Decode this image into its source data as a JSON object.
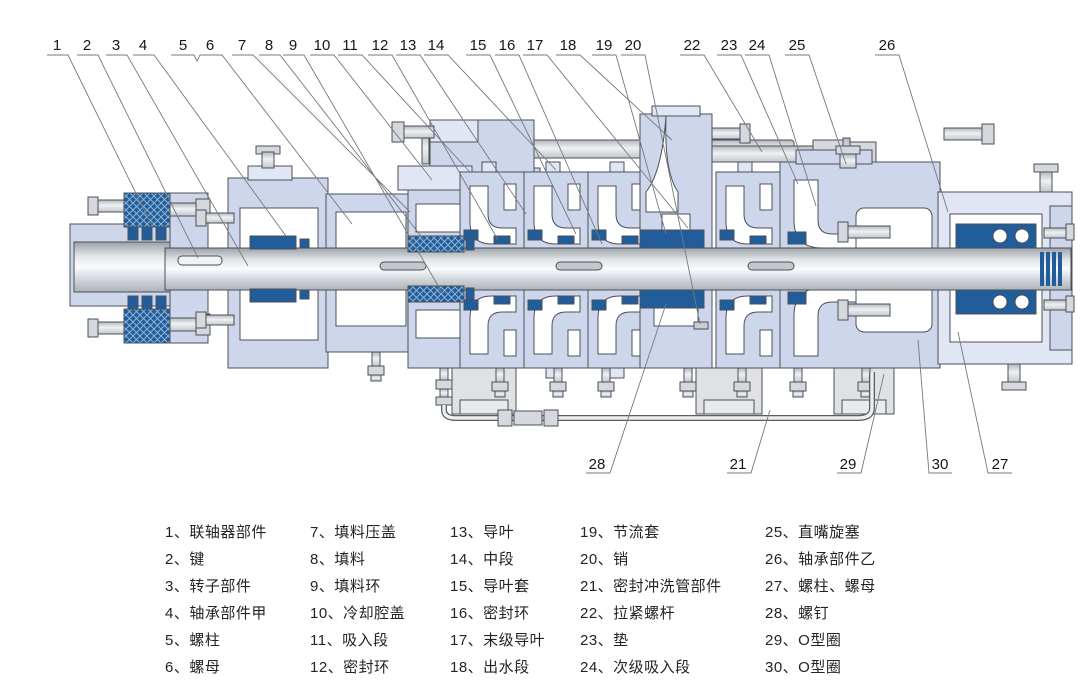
{
  "diagram_title": "multistage-pump-cross-section",
  "colors": {
    "casing": "#cdd6ea",
    "casing_light": "#e0e6f4",
    "dark_blue": "#205d9a",
    "hatch_line": "#8fb4d6",
    "outline": "#4b5058",
    "white": "#ffffff",
    "foot_gray": "#e0e1e3",
    "metal_gray": "#d5d9dd",
    "leader_gray": "#75797f"
  },
  "callouts": {
    "top": [
      {
        "n": "1",
        "x": 57,
        "y": 50,
        "leader": [
          [
            47,
            55
          ],
          [
            68,
            55
          ],
          [
            152,
            226
          ]
        ]
      },
      {
        "n": "2",
        "x": 87,
        "y": 50,
        "leader": [
          [
            77,
            55
          ],
          [
            98,
            55
          ],
          [
            198,
            258
          ]
        ]
      },
      {
        "n": "3",
        "x": 116,
        "y": 50,
        "leader": [
          [
            106,
            55
          ],
          [
            127,
            55
          ],
          [
            248,
            266
          ]
        ]
      },
      {
        "n": "4",
        "x": 143,
        "y": 50,
        "leader": [
          [
            133,
            55
          ],
          [
            154,
            55
          ],
          [
            286,
            236
          ]
        ]
      },
      {
        "n": "5",
        "x": 183,
        "y": 50,
        "leader": [
          [
            171,
            55
          ],
          [
            194,
            55
          ],
          [
            197,
            61
          ],
          [
            200,
            55
          ]
        ]
      },
      {
        "n": "6",
        "x": 210,
        "y": 50,
        "leader": [
          [
            200,
            55
          ],
          [
            222,
            55
          ],
          [
            352,
            224
          ]
        ]
      },
      {
        "n": "7",
        "x": 242,
        "y": 50,
        "leader": [
          [
            232,
            55
          ],
          [
            253,
            55
          ],
          [
            410,
            212
          ]
        ]
      },
      {
        "n": "8",
        "x": 269,
        "y": 50,
        "leader": [
          [
            259,
            55
          ],
          [
            280,
            55
          ],
          [
            424,
            240
          ]
        ]
      },
      {
        "n": "9",
        "x": 293,
        "y": 50,
        "leader": [
          [
            283,
            55
          ],
          [
            304,
            55
          ],
          [
            444,
            296
          ]
        ]
      },
      {
        "n": "10",
        "x": 322,
        "y": 50,
        "leader": [
          [
            310,
            55
          ],
          [
            334,
            55
          ],
          [
            432,
            180
          ]
        ]
      },
      {
        "n": "11",
        "x": 350,
        "y": 50,
        "leader": [
          [
            338,
            55
          ],
          [
            362,
            55
          ],
          [
            470,
            172
          ]
        ]
      },
      {
        "n": "12",
        "x": 380,
        "y": 50,
        "leader": [
          [
            368,
            55
          ],
          [
            392,
            55
          ],
          [
            498,
            240
          ]
        ]
      },
      {
        "n": "13",
        "x": 408,
        "y": 50,
        "leader": [
          [
            396,
            55
          ],
          [
            420,
            55
          ],
          [
            526,
            214
          ]
        ]
      },
      {
        "n": "14",
        "x": 436,
        "y": 50,
        "leader": [
          [
            424,
            55
          ],
          [
            448,
            55
          ],
          [
            556,
            170
          ]
        ]
      },
      {
        "n": "15",
        "x": 478,
        "y": 50,
        "leader": [
          [
            466,
            55
          ],
          [
            490,
            55
          ],
          [
            576,
            234
          ]
        ]
      },
      {
        "n": "16",
        "x": 507,
        "y": 50,
        "leader": [
          [
            495,
            55
          ],
          [
            519,
            55
          ],
          [
            602,
            244
          ]
        ]
      },
      {
        "n": "17",
        "x": 535,
        "y": 50,
        "leader": [
          [
            523,
            55
          ],
          [
            547,
            55
          ],
          [
            688,
            228
          ]
        ]
      },
      {
        "n": "18",
        "x": 568,
        "y": 50,
        "leader": [
          [
            556,
            55
          ],
          [
            580,
            55
          ],
          [
            672,
            140
          ]
        ]
      },
      {
        "n": "19",
        "x": 604,
        "y": 50,
        "leader": [
          [
            592,
            55
          ],
          [
            616,
            55
          ],
          [
            666,
            234
          ]
        ]
      },
      {
        "n": "20",
        "x": 633,
        "y": 50,
        "leader": [
          [
            621,
            55
          ],
          [
            645,
            55
          ],
          [
            700,
            324
          ]
        ]
      },
      {
        "n": "22",
        "x": 692,
        "y": 50,
        "leader": [
          [
            680,
            55
          ],
          [
            704,
            55
          ],
          [
            762,
            152
          ]
        ]
      },
      {
        "n": "23",
        "x": 729,
        "y": 50,
        "leader": [
          [
            717,
            55
          ],
          [
            741,
            55
          ],
          [
            798,
            184
          ]
        ]
      },
      {
        "n": "24",
        "x": 757,
        "y": 50,
        "leader": [
          [
            745,
            55
          ],
          [
            769,
            55
          ],
          [
            816,
            206
          ]
        ]
      },
      {
        "n": "25",
        "x": 797,
        "y": 50,
        "leader": [
          [
            785,
            55
          ],
          [
            809,
            55
          ],
          [
            846,
            164
          ]
        ]
      },
      {
        "n": "26",
        "x": 887,
        "y": 50,
        "leader": [
          [
            875,
            55
          ],
          [
            899,
            55
          ],
          [
            948,
            212
          ]
        ]
      }
    ],
    "bottom": [
      {
        "n": "28",
        "x": 597,
        "y": 469,
        "leader": [
          [
            586,
            473
          ],
          [
            610,
            473
          ],
          [
            666,
            304
          ]
        ]
      },
      {
        "n": "21",
        "x": 738,
        "y": 469,
        "leader": [
          [
            727,
            473
          ],
          [
            751,
            473
          ],
          [
            770,
            410
          ]
        ]
      },
      {
        "n": "29",
        "x": 848,
        "y": 469,
        "leader": [
          [
            837,
            473
          ],
          [
            861,
            473
          ],
          [
            884,
            374
          ]
        ]
      },
      {
        "n": "30",
        "x": 940,
        "y": 469,
        "leader": [
          [
            918,
            340
          ],
          [
            929,
            473
          ],
          [
            952,
            473
          ]
        ]
      },
      {
        "n": "27",
        "x": 1000,
        "y": 469,
        "leader": [
          [
            958,
            332
          ],
          [
            988,
            473
          ],
          [
            1012,
            473
          ]
        ]
      }
    ]
  },
  "legend": {
    "columns": [
      {
        "x": 165,
        "items": [
          "1、联轴器部件",
          "2、键",
          "3、转子部件",
          "4、轴承部件甲",
          "5、螺柱",
          "6、螺母"
        ]
      },
      {
        "x": 310,
        "items": [
          "7、填料压盖",
          "8、填料",
          "9、填料环",
          "10、冷却腔盖",
          "11、吸入段",
          "12、密封环"
        ]
      },
      {
        "x": 450,
        "items": [
          "13、导叶",
          "14、中段",
          "15、导叶套",
          "16、密封环",
          "17、末级导叶",
          "18、出水段"
        ]
      },
      {
        "x": 580,
        "items": [
          "19、节流套",
          "20、销",
          "21、密封冲洗管部件",
          "22、拉紧螺杆",
          "23、垫",
          "24、次级吸入段"
        ]
      },
      {
        "x": 765,
        "items": [
          "25、直嘴旋塞",
          "26、轴承部件乙",
          "27、螺柱、螺母",
          "28、螺钉",
          "29、O型圈",
          "30、O型圈"
        ]
      }
    ]
  }
}
